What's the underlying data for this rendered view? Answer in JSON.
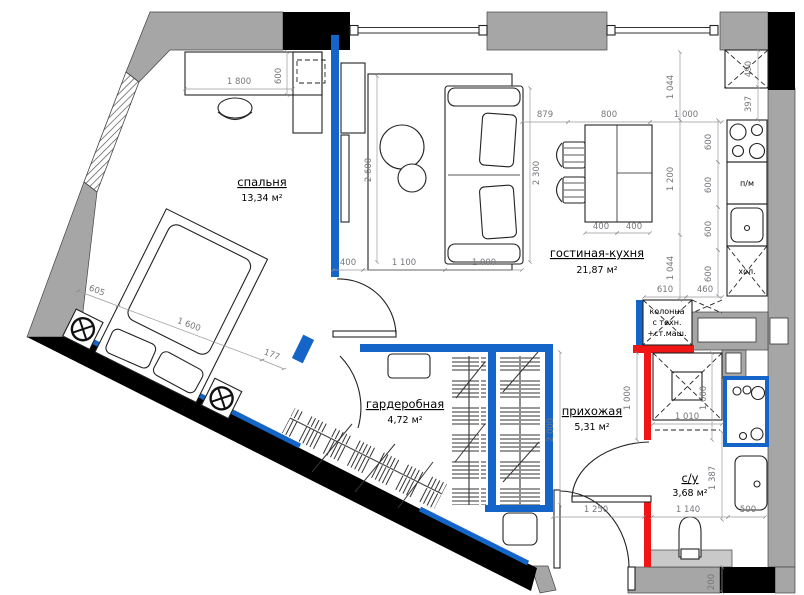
{
  "plan_title": "apartment-floor-plan",
  "rooms": {
    "bedroom": {
      "name": "спальня",
      "area": "13,34 м²"
    },
    "living": {
      "name": "гостиная-кухня",
      "area": "21,87 м²"
    },
    "wardrobe": {
      "name": "гардеробная",
      "area": "4,72 м²"
    },
    "hall": {
      "name": "прихожая",
      "area": "5,31 м²"
    },
    "bath": {
      "name": "с/у",
      "area": "3,68 м²"
    }
  },
  "labels": {
    "dishwasher": "п/м",
    "fridge": "хол.",
    "column1": "колонна",
    "column2": "с техн.",
    "column3": "+ст.маш."
  },
  "dims": {
    "desk_width": "1 800",
    "desk_depth": "600",
    "bed_diag": [
      "605",
      "1 600",
      "177"
    ],
    "rug_height": "2 600",
    "sofa_length": "2 300",
    "top_row": [
      "879",
      "800",
      "1 000"
    ],
    "col_right": [
      "1 044",
      "1 200",
      "1 044"
    ],
    "table_halves": [
      "400",
      "400"
    ],
    "shaft_col": [
      "490",
      "397"
    ],
    "kitchen_units": [
      "600",
      "600",
      "600",
      "600"
    ],
    "column_row": [
      "610",
      "460"
    ],
    "living_row": [
      "400",
      "1 100",
      "1 000"
    ],
    "hall_height": "2 000",
    "hall_width_dim": "1 000",
    "shaft_height_dim": "1 000",
    "shaft_width_dim": "1 010",
    "bath_height": "1 387",
    "bottom_row": [
      "1 250",
      "1 140",
      "500"
    ],
    "wall_offset": "200"
  },
  "colors": {
    "wall_gray": "#a6a6a6",
    "structure_black": "#000000",
    "partition_blue": "#1565c8",
    "new_wall_red": "#f01414",
    "dim_gray": "#76767c"
  }
}
